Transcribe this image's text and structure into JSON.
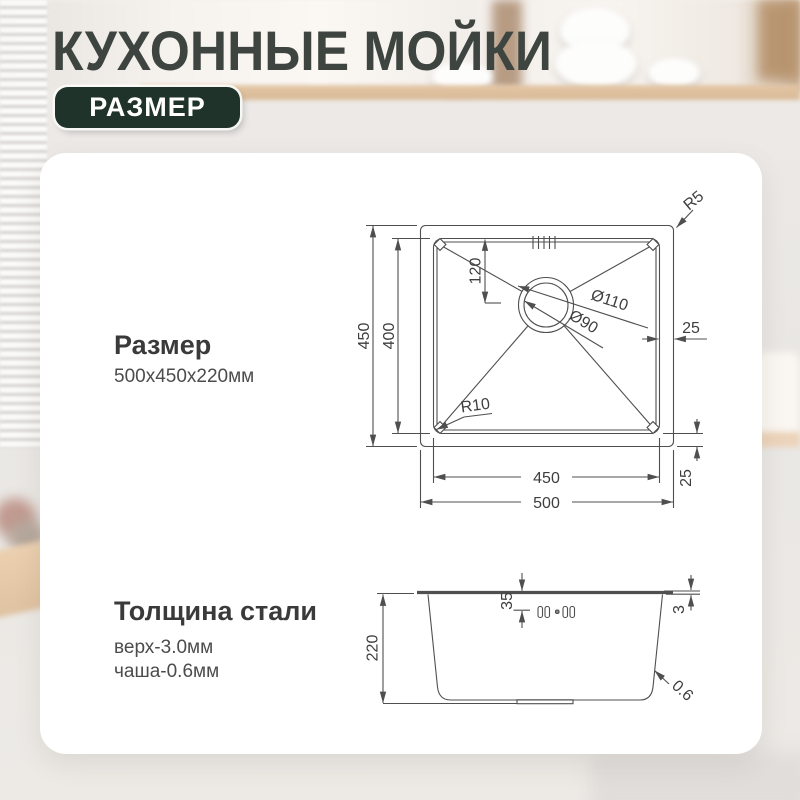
{
  "header": {
    "title": "КУХОННЫЕ МОЙКИ",
    "badge": "РАЗМЕР"
  },
  "size_section": {
    "heading": "Размер",
    "value": "500x450x220мм"
  },
  "thickness_section": {
    "heading": "Толщина стали",
    "top_line": "верх-3.0мм",
    "bowl_line": "чаша-0.6мм"
  },
  "top_view": {
    "outer_height": "450",
    "inner_height": "400",
    "drain_offset": "120",
    "drain_outer_dia": "Ø110",
    "drain_inner_dia": "Ø90",
    "right_inset": "25",
    "corner_radius_outer": "R5",
    "corner_radius_inner": "R10",
    "inner_width": "450",
    "outer_width": "500",
    "bottom_inset": "25"
  },
  "side_view": {
    "height": "220",
    "rim_drop": "35",
    "rim_thickness": "3",
    "wall_thickness": "0.6"
  },
  "colors": {
    "badge_bg": "#1f332a",
    "title_text": "#3e443f",
    "drawing_line": "#4f4f4f",
    "card_bg": "#ffffff"
  }
}
